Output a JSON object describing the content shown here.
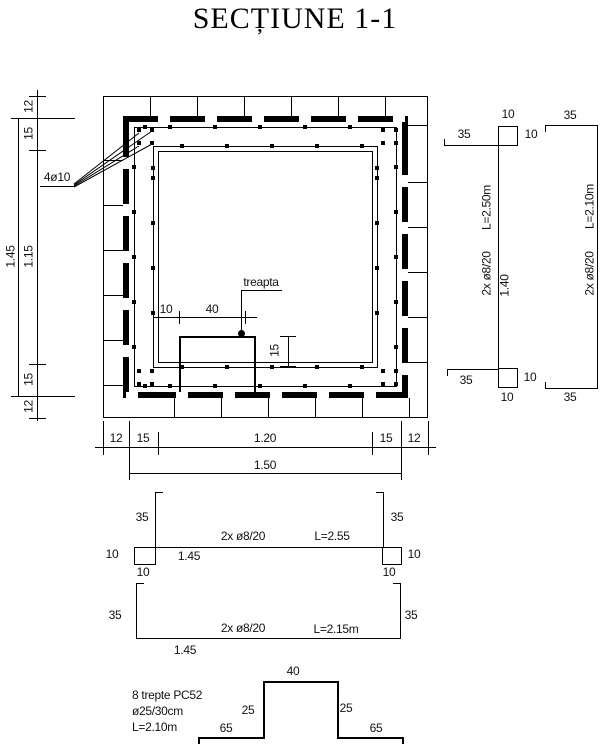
{
  "title": "SECȚIUNE 1-1",
  "ink_color": "#000000",
  "paper_color": "#ffffff",
  "plan": {
    "rebar_corner_label": "4ø10",
    "step_label": "treapta",
    "step_dims": {
      "left": "10",
      "width": "40",
      "depth": "15"
    },
    "left_dims": {
      "masonry_top": "12",
      "wall_top": "15",
      "opening": "1.15",
      "wall_bottom": "15",
      "masonry_bottom": "12",
      "overall": "1.45"
    },
    "bottom_dims": {
      "masonry_left": "12",
      "wall_left": "15",
      "opening": "1.20",
      "wall_right": "15",
      "masonry_right": "12",
      "overall": "1.50"
    }
  },
  "bar_details": {
    "vertical_bar": {
      "hook_top_len": "35",
      "hook_top_w": "10",
      "hook_top_h": "10",
      "length": "L=2.50m",
      "spec": "2x ø8/20",
      "height": "1.40",
      "hook_bot_len": "35",
      "hook_bot_h": "10",
      "hook_bot_w": "10"
    },
    "u_bar_right": {
      "hook_top": "35",
      "length": "L=2.10m",
      "spec": "2x ø8/20",
      "hook_bot": "35"
    },
    "top_bar": {
      "hook_left": "35",
      "hook_right": "35",
      "end_left": "10",
      "end_left_below": "10",
      "end_right": "10",
      "end_right_below": "10",
      "width": "1.45",
      "spec": "2x ø8/20",
      "length": "L=2.55"
    },
    "u_bar_bottom": {
      "hook_left": "35",
      "hook_right": "35",
      "spec": "2x ø8/20",
      "length": "L=2.15m",
      "width": "1.45"
    },
    "step_iron": {
      "note_line1": "8 trepte PC52",
      "note_line2": "ø25/30cm",
      "note_line3": "L=2.10m",
      "top": "40",
      "leg_left": "25",
      "leg_right": "25",
      "foot_left": "65",
      "foot_right": "65"
    }
  }
}
